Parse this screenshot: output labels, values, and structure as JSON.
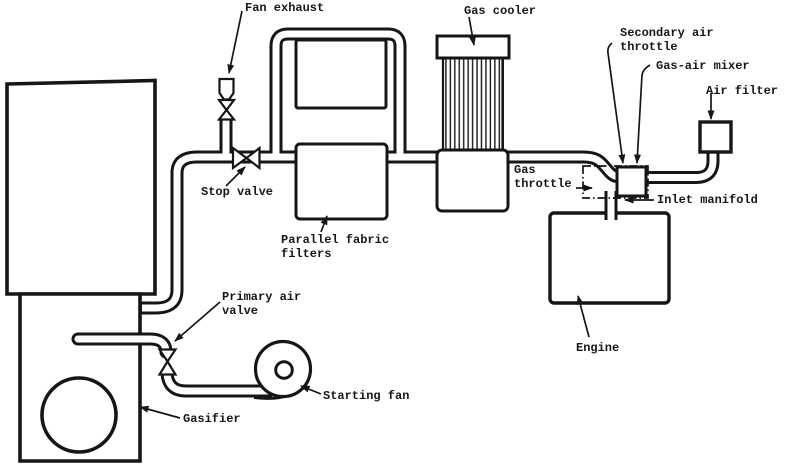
{
  "diagram": {
    "type": "schematic-line-drawing",
    "subject": "Gasifier engine gas supply system",
    "colors": {
      "ink": "#161616",
      "paper": "#ffffff"
    }
  },
  "labels": {
    "fan_exhaust": "Fan exhaust",
    "gas_cooler": "Gas cooler",
    "secondary_air_throttle": [
      "Secondary air",
      "throttle"
    ],
    "gas_air_mixer": "Gas-air mixer",
    "air_filter": "Air filter",
    "gas_throttle": [
      "Gas",
      "throttle"
    ],
    "inlet_manifold": "Inlet manifold",
    "stop_valve": "Stop valve",
    "parallel_fabric_filters": [
      "Parallel fabric",
      "filters"
    ],
    "engine": "Engine",
    "primary_air_valve": [
      "Primary air",
      "valve"
    ],
    "starting_fan": "Starting fan",
    "gasifier": "Gasifier"
  }
}
